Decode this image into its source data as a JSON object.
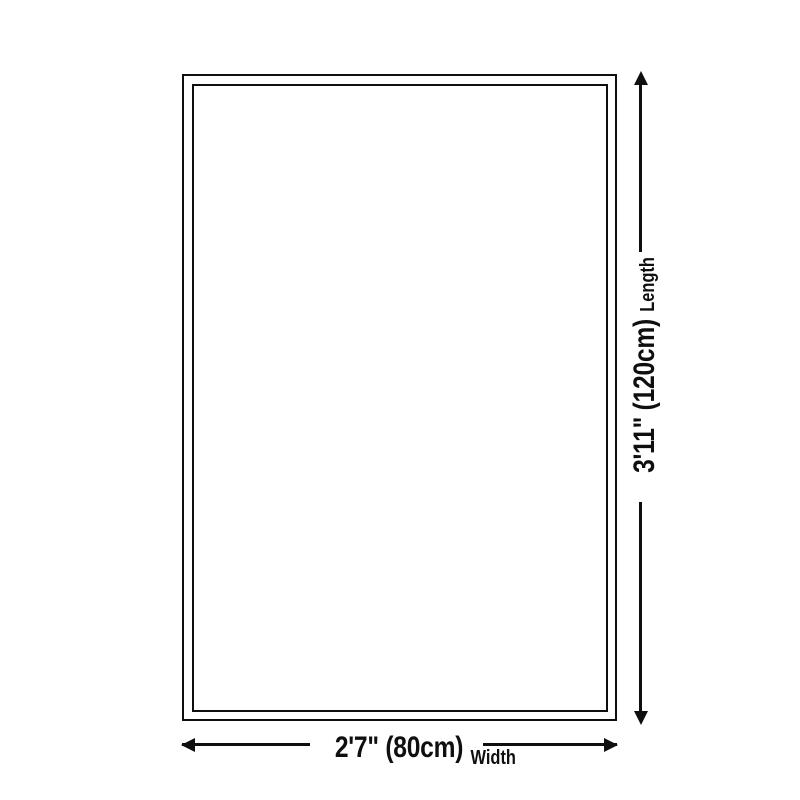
{
  "page": {
    "background": "#ffffff",
    "line_color": "#0f0f0f"
  },
  "diagram": {
    "type": "product-dimension-diagram",
    "shape": "rectangle",
    "length": {
      "value": "3'11\" (120cm)",
      "label": "Length",
      "cm": 120
    },
    "width": {
      "value": "2'7\" (80cm)",
      "label": "Width",
      "cm": 80
    }
  }
}
